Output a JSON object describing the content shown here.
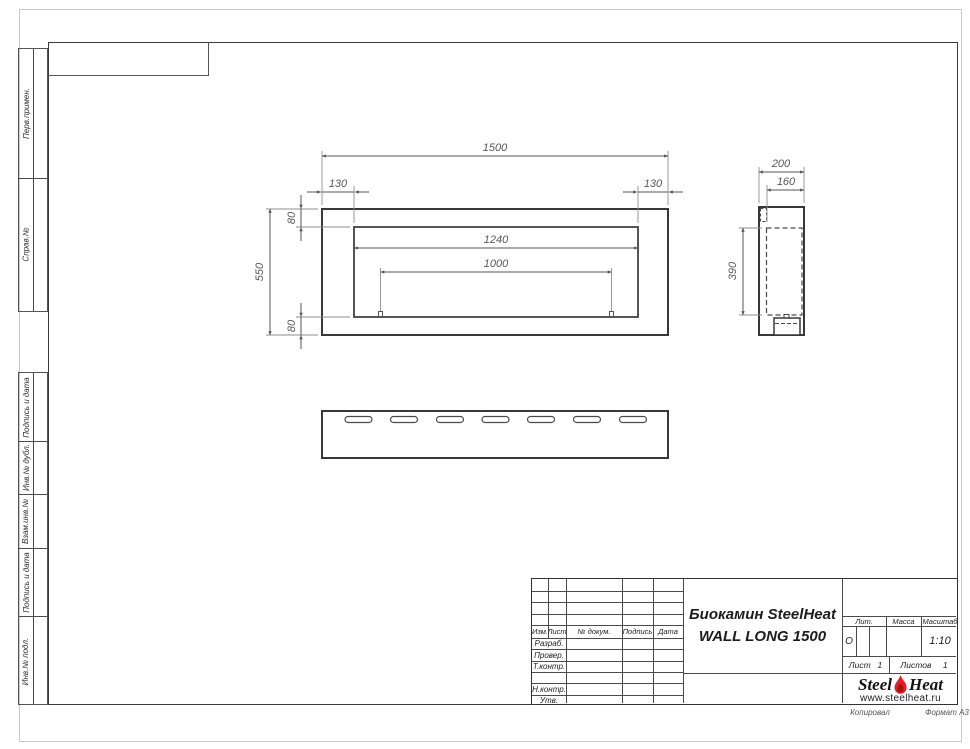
{
  "page": {
    "copy_note": "Копировал",
    "format_note": "Формат А3"
  },
  "margin_labels": {
    "top": [
      "Перв.примен.",
      "Справ.№"
    ],
    "bottom": [
      "Подпись и дата",
      "Инв.№ дубл.",
      "Взам.инв.№",
      "Подпись и дата",
      "Инв.№ подл."
    ]
  },
  "title_block": {
    "change_header": [
      "Изм.",
      "Лист",
      "№ докум.",
      "Подпись",
      "Дата"
    ],
    "signature_rows": [
      "Разраб.",
      "Провер.",
      "Т.контр.",
      "",
      "Н.контр.",
      "Утв."
    ],
    "doc_title_line1": "Биокамин SteelHeat",
    "doc_title_line2": "WALL LONG 1500",
    "lit_label": "Лит.",
    "lit_value": "О",
    "mass_label": "Масса",
    "scale_label": "Масштаб",
    "scale_value": "1:10",
    "sheet_label": "Лист",
    "sheet_number": "1",
    "sheets_label": "Листов",
    "sheets_total": "1",
    "brand": {
      "word1": "Steel",
      "word2": "Heat",
      "website": "www.steelheat.ru",
      "flame_color": "#e31e24"
    }
  },
  "drawing": {
    "type": "engineering_drawing",
    "product": "Биокамин SteelHeat WALL LONG 1500",
    "views": [
      "front",
      "side",
      "bottom"
    ],
    "bottom_slot_count": 7,
    "dimensions_mm": {
      "front_overall_width": "1500",
      "front_left_offset": "130",
      "front_right_offset": "130",
      "front_top_flange": "80",
      "front_overall_height": "550",
      "front_bottom_flange": "80",
      "opening_width": "1240",
      "burner_length": "1000",
      "side_depth": "200",
      "side_inner_depth": "160",
      "side_inner_height": "390"
    }
  }
}
